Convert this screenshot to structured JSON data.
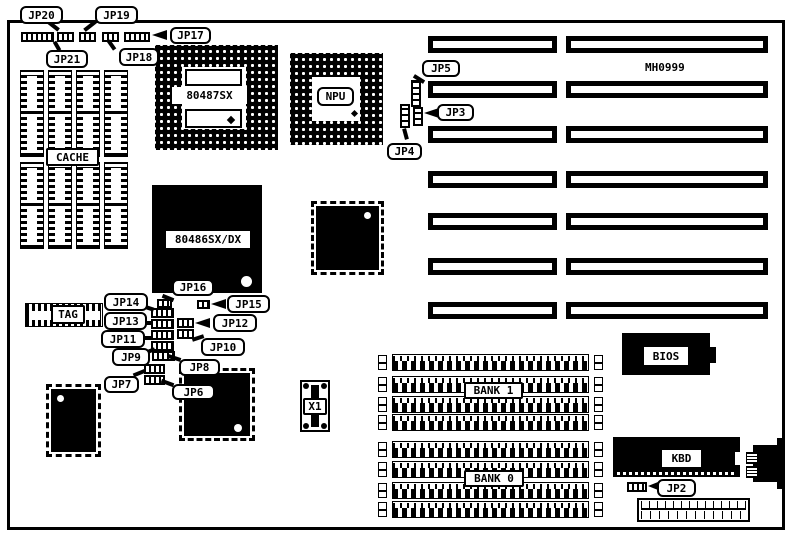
{
  "diagram": {
    "board_id": "MH0999",
    "callouts": {
      "jp2": "JP2",
      "jp3": "JP3",
      "jp4": "JP4",
      "jp5": "JP5",
      "jp6": "JP6",
      "jp7": "JP7",
      "jp8": "JP8",
      "jp9": "JP9",
      "jp10": "JP10",
      "jp11": "JP11",
      "jp12": "JP12",
      "jp13": "JP13",
      "jp14": "JP14",
      "jp15": "JP15",
      "jp16": "JP16",
      "jp17": "JP17",
      "jp18": "JP18",
      "jp19": "JP19",
      "jp20": "JP20",
      "jp21": "JP21"
    },
    "components": {
      "cache": "CACHE",
      "tag": "TAG",
      "coprocessor_socket": "80487SX",
      "npu_socket": "NPU",
      "cpu": "80486SX/DX",
      "bios": "BIOS",
      "keyboard_controller": "KBD",
      "bank1": "BANK 1",
      "bank0": "BANK 0",
      "crystal": "X1"
    },
    "colors": {
      "ink": "#000000",
      "paper": "#ffffff"
    }
  }
}
